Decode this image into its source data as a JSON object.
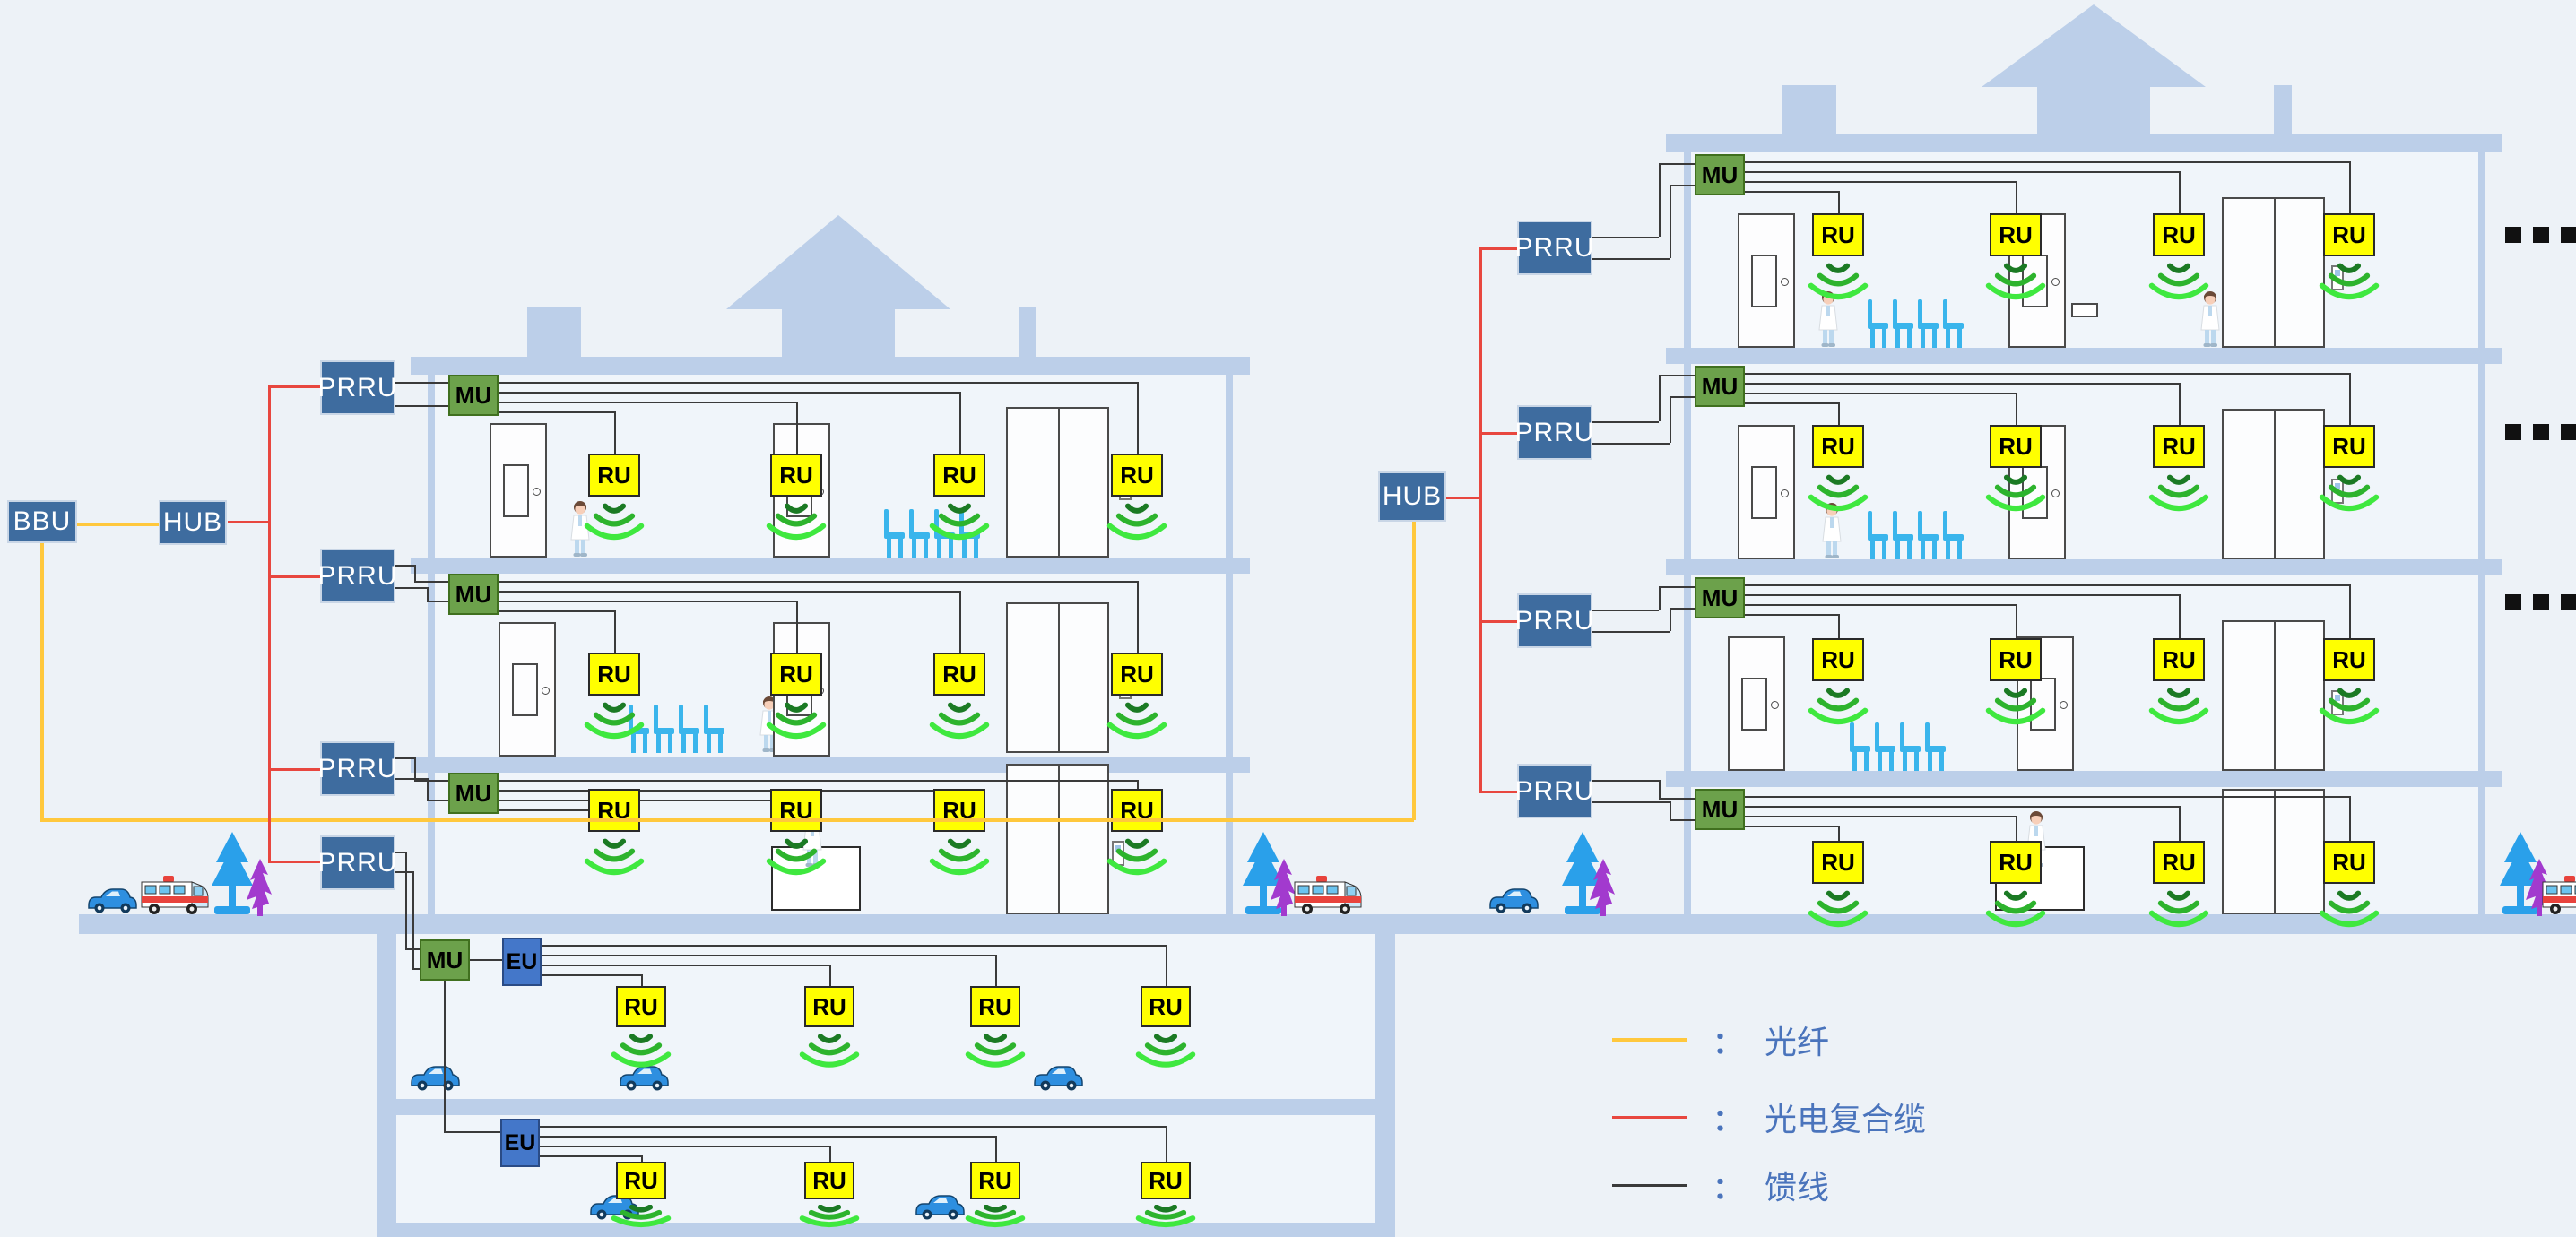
{
  "boxes": {
    "bbu": "BBU",
    "hub": "HUB",
    "prru": "PRRU",
    "mu": "MU",
    "eu": "EU",
    "ru": "RU"
  },
  "legend": {
    "separator": "：",
    "items": [
      {
        "name": "optical-fiber",
        "label": "光纤",
        "color": "#FFC83D"
      },
      {
        "name": "opto-electric-composite-cable",
        "label": "光电复合缆",
        "color": "#E8473F"
      },
      {
        "name": "feeder-line",
        "label": "馈线",
        "color": "#3A3A3A"
      }
    ]
  },
  "more_floors_marker": "...",
  "colors": {
    "background": "#EDF2F7",
    "building": "#BCCFE9",
    "interior": "#F0F5FA",
    "steel_box": "#3E6C9F",
    "steel_border": "#C9D6E6",
    "mu_fill": "#6CA14B",
    "mu_border": "#40701F",
    "eu_fill": "#4477C9",
    "eu_border": "#2A4B85",
    "ru_fill": "#FFFF00",
    "ru_border": "#2A2A2A",
    "feeder": "#3A3A3A",
    "fiber": "#FFC83D",
    "composite": "#E8473F",
    "wifi_arcs": [
      "#1B7A24",
      "#2DB32D",
      "#3FE83F"
    ],
    "chair": "#3AB5EC",
    "tree_blue": "#2AA0EA",
    "tree_purple": "#A23ACE",
    "legend_text": "#4A74BC",
    "car": "#2E8FE0",
    "ambulance_red": "#E8433C"
  }
}
